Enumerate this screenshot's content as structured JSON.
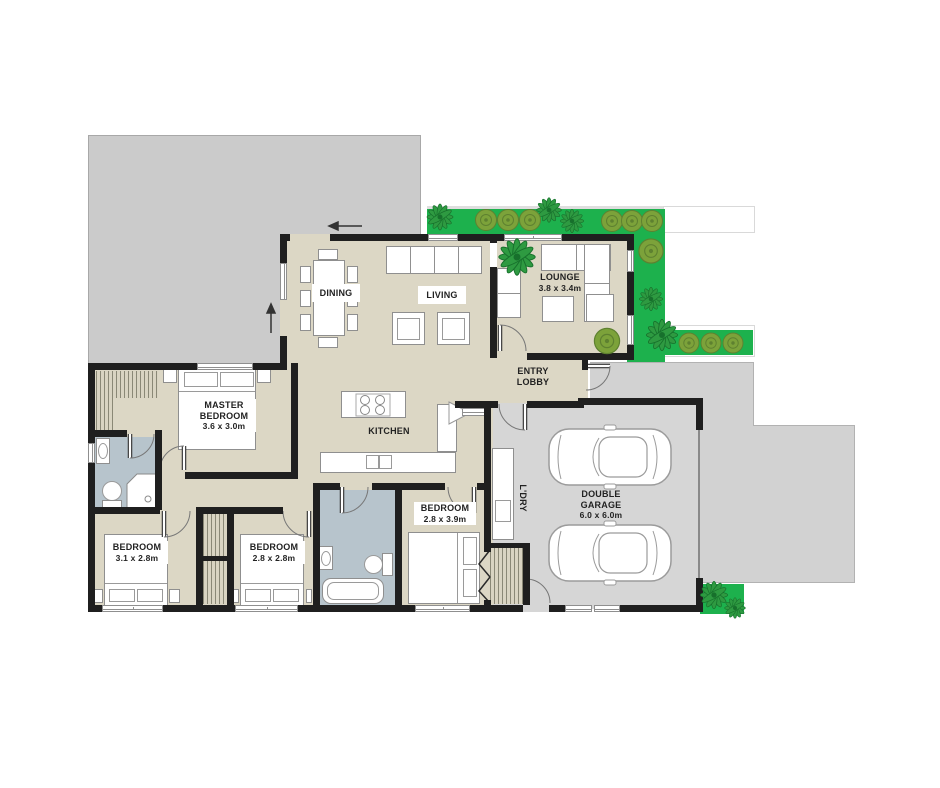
{
  "rooms": {
    "dining": {
      "label": "DINING"
    },
    "living": {
      "label": "LIVING"
    },
    "lounge": {
      "label": "LOUNGE",
      "dims": "3.8 x 3.4m"
    },
    "entry": {
      "label": "ENTRY LOBBY"
    },
    "kitchen": {
      "label": "KITCHEN"
    },
    "master": {
      "label": "MASTER BEDROOM",
      "dims": "3.6 x 3.0m"
    },
    "bedroom1": {
      "label": "BEDROOM",
      "dims": "3.1 x 2.8m"
    },
    "bedroom2": {
      "label": "BEDROOM",
      "dims": "2.8 x 2.8m"
    },
    "bedroom3": {
      "label": "BEDROOM",
      "dims": "2.8 x 3.9m"
    },
    "laundry": {
      "label": "L'DRY"
    },
    "garage": {
      "label": "DOUBLE GARAGE",
      "dims": "6.0 x 6.0m"
    }
  },
  "colors": {
    "wall": "#1f1f1f",
    "floor": "#dcd7c5",
    "wet_area": "#b7c4cc",
    "deck_green": "#1db14d",
    "garage_floor": "#d6d6d6",
    "driveway": "#d2d2d2",
    "gray_block": "#cbcbcb"
  }
}
